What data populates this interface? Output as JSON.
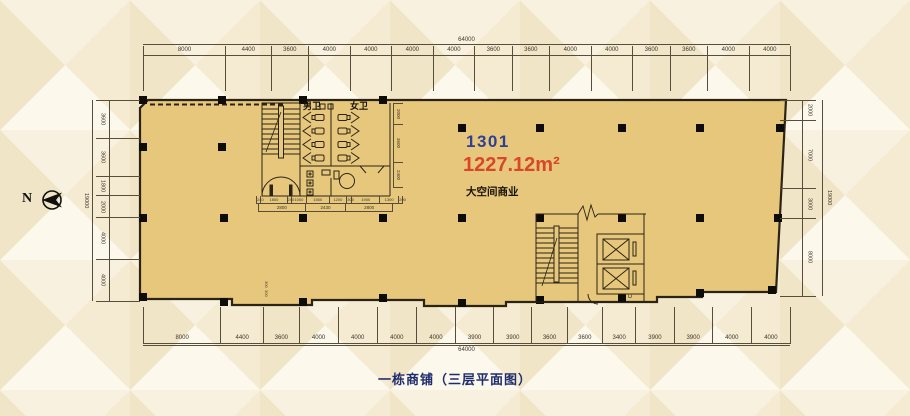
{
  "page": {
    "caption": "一栋商铺（三层平面图）"
  },
  "compass": {
    "label": "N"
  },
  "unit": {
    "number": "1301",
    "area": "1227.12m²",
    "type": "大空间商业"
  },
  "rooms": {
    "men_wc": "男卫",
    "women_wc": "女卫",
    "elevator_label": "D"
  },
  "dims": {
    "overall_width_top": "64000",
    "overall_width_bottom": "64000",
    "overall_height_left": "19000",
    "overall_height_right": "19000",
    "top": [
      "8000",
      "4400",
      "3600",
      "4000",
      "4000",
      "4000",
      "4000",
      "3600",
      "3600",
      "4000",
      "4000",
      "3600",
      "3600",
      "4000",
      "4000"
    ],
    "bottom": [
      "8000",
      "4400",
      "3600",
      "4000",
      "4000",
      "4000",
      "4000",
      "3900",
      "3900",
      "3600",
      "3600",
      "3400",
      "3900",
      "3900",
      "4000",
      "4000"
    ],
    "left": [
      "3600",
      "3600",
      "1800",
      "2000",
      "4000",
      "4000"
    ],
    "right": [
      "2000",
      "7000",
      "3000",
      "8000"
    ],
    "wc_right": [
      "2000",
      "3600",
      "2400"
    ],
    "wc_row1": [
      "240",
      "1800",
      "240",
      "1000",
      "1550",
      "1200",
      "300",
      "1900",
      "1300",
      "200"
    ],
    "wc_row2": [
      "2800",
      "2430",
      "2800"
    ],
    "notch": [
      "300",
      "300"
    ]
  },
  "colors": {
    "floor": "#e7c77b",
    "wall": "#2b2416",
    "unit_number": "#2e3f94",
    "area": "#d8472a",
    "caption": "#1f2c6d"
  }
}
